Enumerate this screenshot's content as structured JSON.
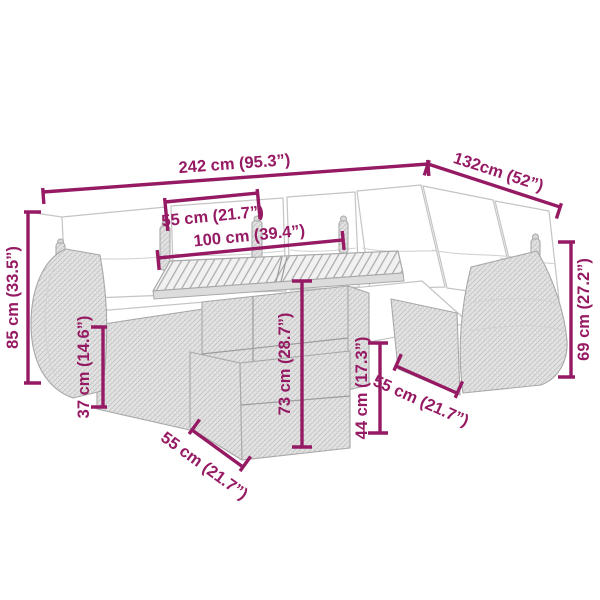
{
  "colors": {
    "accent": "#951A63",
    "line": "#A8A8A8",
    "cushion_line": "#C4C4C4"
  },
  "dimensions": {
    "total_width": {
      "label": "242 cm (95.3”)",
      "value_cm": 242,
      "value_in": 95.3
    },
    "total_depth": {
      "label": "132cm (52”)",
      "value_cm": 132,
      "value_in": 52
    },
    "tabletop_depth": {
      "label": "55 cm (21.7”)",
      "value_cm": 55,
      "value_in": 21.7
    },
    "tabletop_width": {
      "label": "100 cm (39.4”)",
      "value_cm": 100,
      "value_in": 39.4
    },
    "back_height": {
      "label": "85 cm (33.5”)",
      "value_cm": 85,
      "value_in": 33.5
    },
    "seat_height": {
      "label": "37 cm (14.6”)",
      "value_cm": 37,
      "value_in": 14.6
    },
    "table_height": {
      "label": "73 cm (28.7”)",
      "value_cm": 73,
      "value_in": 28.7
    },
    "stool_height": {
      "label": "44 cm (17.3”)",
      "value_cm": 44,
      "value_in": 17.3
    },
    "armrest_height": {
      "label": "69 cm (27.2”)",
      "value_cm": 69,
      "value_in": 27.2
    },
    "stool_depth": {
      "label": "55 cm (21.7”)",
      "value_cm": 55,
      "value_in": 21.7
    },
    "seat_depth": {
      "label": "55 cm (21.7”)",
      "value_cm": 55,
      "value_in": 21.7
    }
  }
}
